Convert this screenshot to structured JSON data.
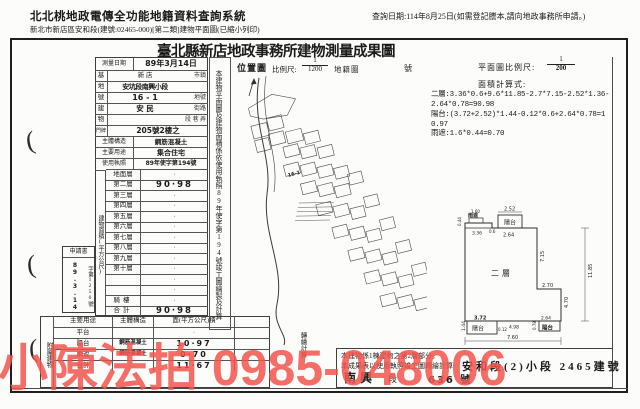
{
  "header": {
    "system_title": "北北桃地政電傳全功能地籍資料查詢系統",
    "subtitle": "新北市新店區安和段(建號:02465-000)[第二類]建物平面圖(已縮小列印)",
    "query_date": "查詢日期:114年8月25日(如需登記謄本,請向地政事務所申請。)"
  },
  "title": "臺北縣新店地政事務所建物測量成果圖",
  "survey_form": {
    "survey_date_label": "測量日期",
    "survey_date_value": "89年3月14日",
    "site_rows": [
      {
        "label": "基",
        "value": "新 店",
        "suffix": "市鎮"
      },
      {
        "label": "地",
        "value": "安坑段南興小段",
        "suffix": ""
      },
      {
        "label": "號",
        "value": "16 - 1",
        "suffix": "地號"
      },
      {
        "label": "建",
        "value": "安 民",
        "suffix": "街路"
      },
      {
        "label": "物",
        "value": "",
        "suffix": "段 巷 弄"
      },
      {
        "label": "門牌",
        "value": "205號2樓之",
        "suffix": ""
      }
    ],
    "structure_label": "主體構造",
    "structure_value": "鋼筋混凝土",
    "usage_label": "主要用途",
    "usage_value": "集合住宅",
    "license_label": "使用執照",
    "license_value": "89年使字第194號",
    "area_label": "建物面積(平方公尺)",
    "floor_rows": [
      {
        "label": "地面層",
        "value": "·"
      },
      {
        "label": "第二層",
        "value": "90·98"
      },
      {
        "label": "第三層",
        "value": "·"
      },
      {
        "label": "第四層",
        "value": "·"
      },
      {
        "label": "第五層",
        "value": "·"
      },
      {
        "label": "第六層",
        "value": "·"
      },
      {
        "label": "第七層",
        "value": "·"
      },
      {
        "label": "第八層",
        "value": "·"
      },
      {
        "label": "第九層",
        "value": "·"
      },
      {
        "label": "第十層",
        "value": "·"
      },
      {
        "label": "",
        "value": "·"
      },
      {
        "label": "",
        "value": "·"
      },
      {
        "label": "騎樓",
        "value": "·"
      },
      {
        "label": "合計",
        "value": "90·98"
      }
    ],
    "annex_label": "附屬建物",
    "annex_header": {
      "usage": "主要用途",
      "structure": "主體構造",
      "area": "面(平方公尺)積"
    },
    "annex_rows": [
      {
        "usage": "平台",
        "structure": "",
        "area": "·"
      },
      {
        "usage": "陽台",
        "structure": "鋼筋混凝土",
        "area": "10·97"
      },
      {
        "usage": "雨遮",
        "structure": "鋼筋混凝土",
        "area": "0·70"
      },
      {
        "usage": "合計",
        "structure": "",
        "area": "11·67"
      }
    ],
    "application": {
      "title": "申請書",
      "date": "89.3.14",
      "number": "字第1250號"
    },
    "side_note": "本建物平面圖及建物面積係依使用執照89年使字第194號竣工圖繪製及計算",
    "side_note_tail": "轉繪計算"
  },
  "location_map": {
    "title": "位置圖",
    "scale_label": "比例尺:",
    "scale_numerator": "1",
    "scale_denominator": "1200",
    "map_type": "地籍圖",
    "number_label": "號",
    "parcel_label": "16-1"
  },
  "floor_plan": {
    "scale_label": "平面圖比例尺:",
    "scale_numerator": "1",
    "scale_denominator": "200",
    "calc_title": "面積計算式:",
    "calc_lines": [
      "二層:3.36*0.6+9.6*11.85-2.7*7.15-2.52*1.36-2.64*0.78=90.98",
      "陽台:(3.72+2.52)*1.44-0.12*0.6+2.64*0.78=10.97",
      "雨遮:1.6*0.44=0.70"
    ],
    "room_label": "二層",
    "balcony_label": "陽台",
    "canopy_label": "雨遮",
    "dims": {
      "top_balcony_width": "2.52",
      "top_offset": "2.64",
      "canopy_width": "1.60",
      "canopy_depth": "0.44",
      "bump_width": "3.36",
      "bump_depth": "0.6",
      "right_upper": "7.15",
      "right_total": "11.85",
      "notch_width": "2.70",
      "right_lower": "4.70",
      "left_balcony_width": "3.72",
      "left_balcony_depth": "1.44",
      "left_balcony_offset": "0.12",
      "bottom_middle": "4.98",
      "right_balcony_width": "2.64",
      "right_balcony_depth": "0.78",
      "bottom_total": "7.60"
    }
  },
  "notes": {
    "line1": "本建物係1棟建物之第2層部分。",
    "line2": "本成果表以使用執照竣工圖轉繪計算",
    "stamp": "安和段(2)小段 2465建號",
    "hw_name": "南興",
    "hw_mid": "段",
    "hw_num": "636 號"
  },
  "watermark": {
    "text": "小陳法拍 0985-048006",
    "color": "#f2544d"
  }
}
